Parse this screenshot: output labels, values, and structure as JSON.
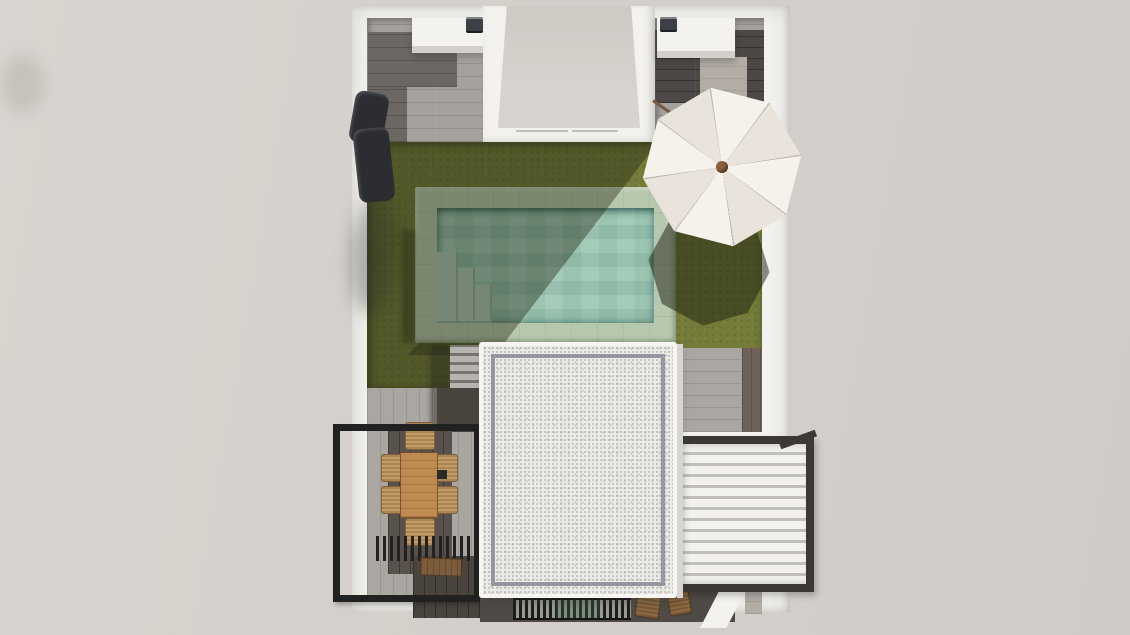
{
  "scene": {
    "type": "architectural-top-view-3d-render",
    "description": "Top-down 3D rendering of a walled villa plot with garden, pool, parasol, dining pergola, flat gravel roof and louvered pergola",
    "visible_text": "none"
  },
  "objects": {
    "plot": "walled villa plot",
    "left_courtyard": "side patio with grey stone tiles",
    "right_courtyard": "side patio with dark wood-look tiles and stone path",
    "entry_patio": "central entry patio with white parapet walls",
    "outdoor_kitchen_left": "white outdoor kitchen unit with barbecue",
    "outdoor_kitchen_right": "white outdoor kitchen unit with barbecue",
    "lawn": "olive green garden lawn",
    "pool": "swimming pool with pale stone surround",
    "pool_steps": "corner entry steps inside pool",
    "parasol": "white octagonal garden parasol",
    "parasol_shadow": "parasol shadow on lawn",
    "building_shadow": "diagonal building shadow over lawn and pool",
    "sun_lounger": "black sun lounger leaning on west wall",
    "flat_roof": "white gravel flat roof of villa",
    "garden_steps": "stone steps beside roof",
    "dining_pergola": "black steel pergola over timber deck",
    "dining_table": "rectangular wooden dining table",
    "dining_chairs": "wicker dining chairs",
    "bench": "wooden bench under slatted shade",
    "timber_deck": "dark timber deck",
    "louvered_pergola": "white bioclimatic louvered pergola",
    "drainage_grate": "linear black drainage grate",
    "rear_furniture": "stacked wooden chairs at rear terrace",
    "side_paving": "grey plank paving",
    "dark_path": "dark timber path strip"
  },
  "counts": {
    "dining_chairs": 6,
    "parasol_panels": 8,
    "louver_slats": 13,
    "outdoor_kitchens": 2
  },
  "palette": {
    "bg": "#d4cfca",
    "bg_light": "#d9d4cf",
    "bg_dark": "#cfccc8",
    "wall": "#f4f2ee",
    "wall_shade": "#d8d4cf",
    "floor_center": "#cfc9c4",
    "floor_center2": "#d8d3ce",
    "tile_light": "#a5a19d",
    "tile_dark": "#6b6763",
    "wood_tile": "#4d4845",
    "path_light": "#b2aca5",
    "bbq": "#3c4046",
    "lawn": "#757c3a",
    "coping": "#b6c8ad",
    "water": "#9bc5b1",
    "pool_step": "#b0ccb9",
    "paving": "#aaa6a1",
    "dark_path": "#6e6258",
    "step": "#b8b4b0",
    "deck": "#59524c",
    "deck_dark": "#4a443f",
    "frame": "#212121",
    "table": "#bf8a50",
    "chair": "#c59c63",
    "chair_dark": "#8f6b42",
    "bench": "#7d5c3c",
    "roof": "#edebe7",
    "louver": "#f3f1ee",
    "louver_gap": "#c2bfba",
    "louver_frame": "#3b3835",
    "grate": "#1c1c1c",
    "grate_gap": "#989b92",
    "dark_strip": "#4f4a46",
    "umbrella": "#f5f1eb",
    "umbrella_shade": "#e9e3db",
    "hub": "#8a5f3e",
    "pole": "#7a5a40",
    "lounger": "#2b2d31"
  }
}
